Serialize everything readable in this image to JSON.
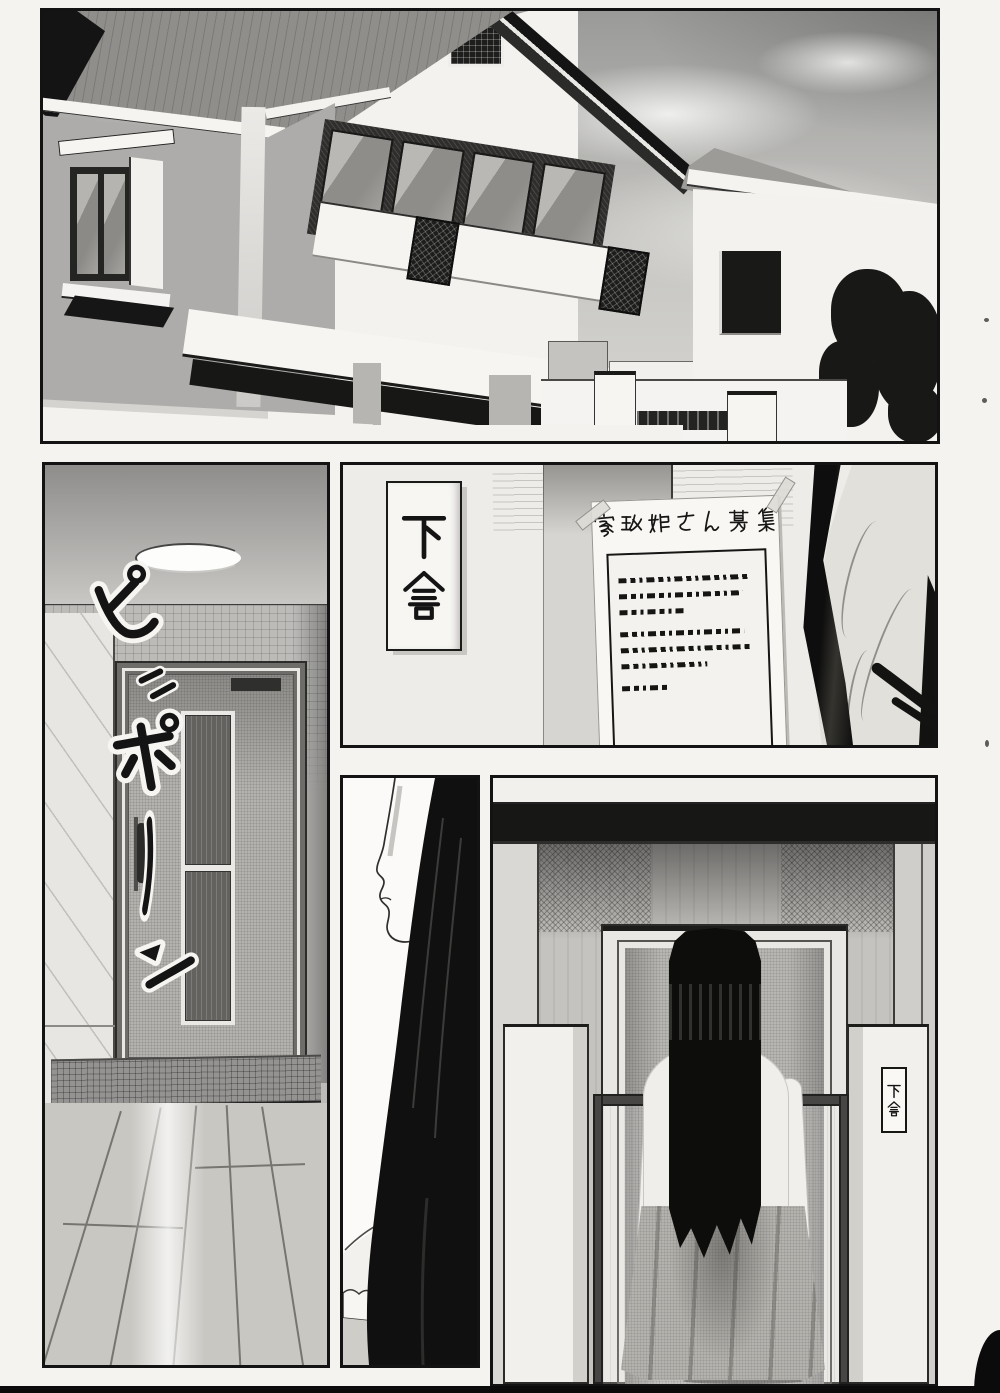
{
  "page": {
    "kind": "scanned manga page, grayscale halftone artwork",
    "background_color": "#f4f3f0",
    "ink_color": "#141414"
  },
  "panel_house": {
    "label": "Exterior of a two-story house under an overcast cloudy sky; dark pitched roofs, wood-siding walls, bay window, upstairs window row behind a white balcony with mesh panels, attic vent grate, low garden wall with gate posts and railing, dark trees at right"
  },
  "panel_entryway": {
    "label": "Entry hall (genkan) seen from inside: ceiling light, tiled wall, front door with tall window strip, wooden floor; doorbell sound effect",
    "sfx": {
      "text": "ピンポーン",
      "chars": [
        "ピ",
        "ン",
        "ポ",
        "ー",
        "ン"
      ]
    }
  },
  "panel_doorplate": {
    "label": "Wall by the front door: name plate, tiled pillar, taped recruitment poster; woman's shoulder and long dark hair at right",
    "nameplate": {
      "text": "下倉",
      "chars": [
        "下",
        "倉"
      ]
    },
    "poster": {
      "title": "家政婦さん募集",
      "title_chars": [
        "家",
        "政",
        "婦",
        "さ",
        "ん",
        "募",
        "集"
      ],
      "body_line_groups": [
        [
          95,
          90,
          48
        ],
        [
          90,
          95,
          62
        ],
        [
          35
        ]
      ]
    }
  },
  "panel_profile": {
    "label": "Close-up profile of the woman's nose, lips and chin facing left, long black hair, frilled blouse edge at lower left"
  },
  "panel_gate": {
    "label": "Woman with very long straight black hair, white blouse and long skirt, standing at the front gate facing the entrance, seen from behind",
    "nameplate": {
      "text": "下倉",
      "chars": [
        "下",
        "倉"
      ]
    }
  }
}
